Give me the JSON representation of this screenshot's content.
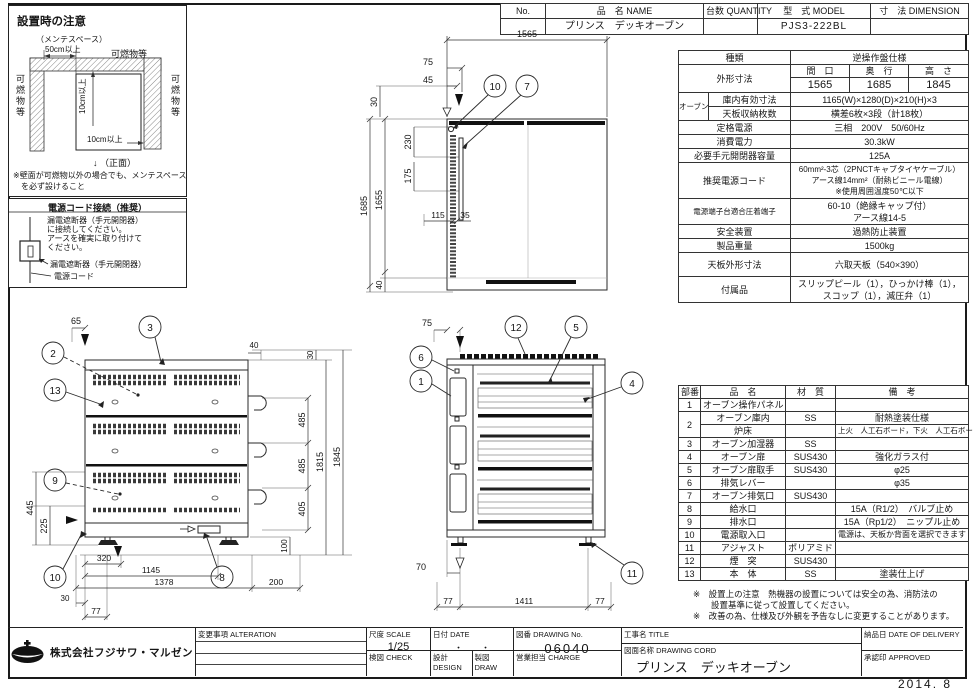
{
  "header": {
    "no_h": "No.",
    "name_h": "品　名 NAME",
    "qty_h": "台数 QUANTITY",
    "model_h": "型　式 MODEL",
    "dim_h": "寸　法 DIMENSION",
    "name_v": "プリンス　デッキオーブン",
    "model_v": "PJS3-222BL"
  },
  "install": {
    "title": "設置時の注意",
    "maint": "（メンテスペース）",
    "s50": "50cm以上",
    "comb_top": "可燃物等",
    "comb_left": "可燃物等",
    "comb_right": "可燃物等",
    "s10v": "10cm以上",
    "s10h": "10cm以上",
    "front_label": "↓ （正面）",
    "note1": "※壁面が可燃物以外の場合でも、メンテスペース",
    "note2": "を必ず設けること"
  },
  "power": {
    "title": "電源コード接続（推奨）",
    "b1": "漏電遮断器（手元開閉器）",
    "b2": "に接続してください。",
    "b3": "アースを確実に取り付けて",
    "b4": "ください。",
    "lbl_breaker": "漏電遮断器（手元開閉器）",
    "lbl_cord": "電源コード"
  },
  "spec": {
    "kind_label": "種類",
    "kind_value": "逆操作盤仕様",
    "dims_label": "外形寸法",
    "w_h": "間　口",
    "d_h": "奥　行",
    "h_h": "高　さ",
    "w_v": "1565",
    "d_v": "1685",
    "h_v": "1845",
    "oven_label": "オーブン",
    "inner_label": "庫内有効寸法",
    "inner_value": "1165(W)×1280(D)×210(H)×3",
    "tray_label": "天板収納枚数",
    "tray_value": "横差6枚×3段（計18枚）",
    "rated_label": "定格電源",
    "rated_value": "三相　200V　50/60Hz",
    "power_label": "消費電力",
    "power_value": "30.3kW",
    "breaker_label": "必要手元開閉器容量",
    "breaker_value": "125A",
    "cord_label": "推奨電源コード",
    "cord_v1": "60mm²-3芯（2PNCTキャブタイヤケーブル）",
    "cord_v2": "アース線14mm²（耐熱ビニール電線）",
    "cord_v3": "※使用周囲温度50℃以下",
    "terminal_label": "電源端子台適合圧着端子",
    "terminal_v1": "60-10（絶縁キャップ付）",
    "terminal_v2": "アース線14-5",
    "safety_label": "安全装置",
    "safety_value": "過熱防止装置",
    "weight_label": "製品重量",
    "weight_value": "1500kg",
    "top_label": "天板外形寸法",
    "top_value": "六取天板（540×390）",
    "acc_label": "付属品",
    "acc_v1": "スリップピール（1），ひっかけ棒（1），",
    "acc_v2": "スコップ（1），減圧弁（1）"
  },
  "parts": {
    "h_num": "部番",
    "h_name": "品　名",
    "h_mat": "材　質",
    "h_note": "備　考",
    "rows": [
      {
        "n": "1",
        "name": "オーブン操作パネル",
        "mat": "",
        "note": ""
      },
      {
        "n": "2",
        "name": "オーブン庫内",
        "mat": "SS",
        "note": "耐熱塗装仕様"
      },
      {
        "n": "",
        "name": "炉床",
        "mat": "",
        "note": "上火　人工石ボード，下火　人工石ボード"
      },
      {
        "n": "3",
        "name": "オーブン加湿器",
        "mat": "SS",
        "note": ""
      },
      {
        "n": "4",
        "name": "オーブン扉",
        "mat": "SUS430",
        "note": "強化ガラス付"
      },
      {
        "n": "5",
        "name": "オーブン扉取手",
        "mat": "SUS430",
        "note": "φ25"
      },
      {
        "n": "6",
        "name": "排気レバー",
        "mat": "",
        "note": "φ35"
      },
      {
        "n": "7",
        "name": "オーブン排気口",
        "mat": "SUS430",
        "note": ""
      },
      {
        "n": "8",
        "name": "給水口",
        "mat": "",
        "note": "15A（R1/2）　バルブ止め"
      },
      {
        "n": "9",
        "name": "排水口",
        "mat": "",
        "note": "15A（Rp1/2）　ニップル止め"
      },
      {
        "n": "10",
        "name": "電源取入口",
        "mat": "",
        "note": "電源は、天板か背面を選択できます"
      },
      {
        "n": "11",
        "name": "アジャスト",
        "mat": "ポリアミド",
        "note": ""
      },
      {
        "n": "12",
        "name": "煙　突",
        "mat": "SUS430",
        "note": ""
      },
      {
        "n": "13",
        "name": "本　体",
        "mat": "SS",
        "note": "塗装仕上げ"
      }
    ]
  },
  "notes": {
    "l1": "※　設置上の注意　熱機器の設置については安全の為、消防法の",
    "l2": "設置基準に従って設置してください。",
    "l3": "※　改善の為、仕様及び外観を予告なしに変更することがあります。"
  },
  "titleblock": {
    "alteration": "変更事項 ALTERATION",
    "scale_label": "尺度 SCALE",
    "scale_value": "1/25",
    "date_label": "日付 DATE",
    "date_value": "・　　・",
    "dwg_label": "図番 DRAWING No.",
    "dwg_value": "06040",
    "check_label": "検図 CHECK",
    "design_label": "設計 DESIGN",
    "draw_label": "製図 DRAW",
    "charge_label": "営業担当 CHARGE",
    "title_label": "工事名 TITLE",
    "name_label": "図面名称 DRAWING CORD",
    "name_value": "プリンス　デッキオーブン",
    "delivery_label": "納品日 DATE OF DELIVERY",
    "approved_label": "承認印 APPROVED",
    "company": "株式会社フジサワ・マルゼン",
    "issue_date": "2014. 8"
  },
  "drawings": {
    "plan": {
      "d1565": "1565",
      "d75": "75",
      "d45": "45",
      "d30": "30",
      "d1685": "1685",
      "d1655": "1655",
      "d40": "40",
      "d230": "230",
      "d175": "175",
      "d115": "115",
      "d35": "35",
      "c10": "10",
      "c7": "7"
    },
    "rear": {
      "d65": "65",
      "d40": "40",
      "d30top": "30",
      "d485a": "485",
      "d485b": "485",
      "d405": "405",
      "d1815": "1815",
      "d1845": "1845",
      "d100": "100",
      "d445": "445",
      "d225": "225",
      "d320": "320",
      "d1145": "1145",
      "d1378": "1378",
      "d200": "200",
      "d30btm": "30",
      "d77": "77",
      "c3": "3",
      "c2": "2",
      "c13": "13",
      "c9": "9",
      "c10": "10",
      "c8": "8"
    },
    "front": {
      "d75": "75",
      "d70": "70",
      "d77l": "77",
      "d1411": "1411",
      "d77r": "77",
      "c12": "12",
      "c5": "5",
      "c6": "6",
      "c1": "1",
      "c4": "4",
      "c11": "11"
    }
  }
}
